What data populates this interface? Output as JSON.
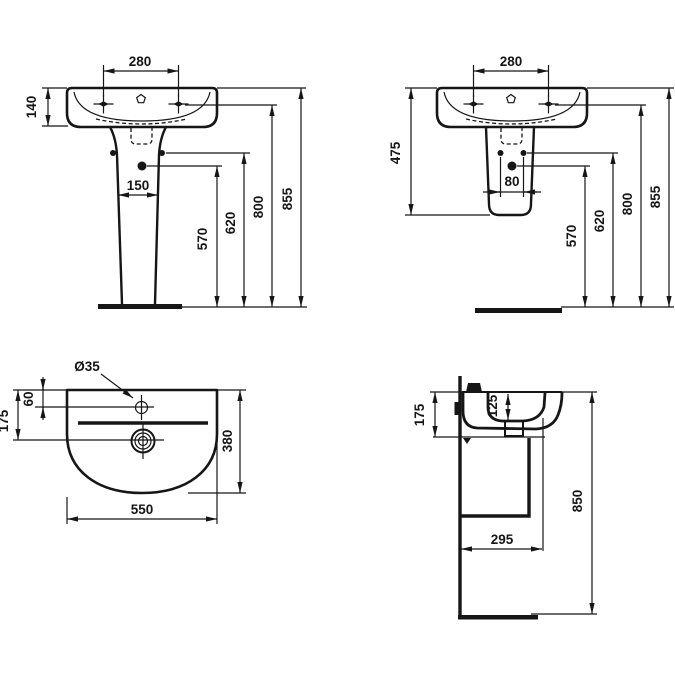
{
  "drawing": {
    "type": "technical-dimension-drawing",
    "subject": "washbasin with pedestal / semi-pedestal",
    "background": "#ffffff",
    "line_color": "#161616",
    "views": {
      "front_full_pedestal": {
        "label": "Front view - basin on full pedestal",
        "dims": {
          "tap_centres": "280",
          "rim_to_underside": "140",
          "pedestal_width": "150",
          "h570": "570",
          "h620": "620",
          "h800": "800",
          "h855": "855"
        }
      },
      "front_semi_pedestal": {
        "label": "Front view - basin on semi-pedestal",
        "dims": {
          "tap_centres": "280",
          "rim_to_pedestal_bottom": "475",
          "fixing_centres": "80",
          "h570": "570",
          "h620": "620",
          "h800": "800",
          "h855": "855"
        }
      },
      "plan": {
        "label": "Plan view",
        "dims": {
          "tap_hole_diameter": "Ø35",
          "back_to_tap_centre": "60",
          "back_to_drain_centre": "175",
          "depth": "380",
          "width": "550"
        }
      },
      "side": {
        "label": "Side section view",
        "dims": {
          "rim_to_underside": "175",
          "bowl_depth": "125",
          "rim_height": "850",
          "wall_to_trap_front": "295"
        }
      }
    }
  }
}
